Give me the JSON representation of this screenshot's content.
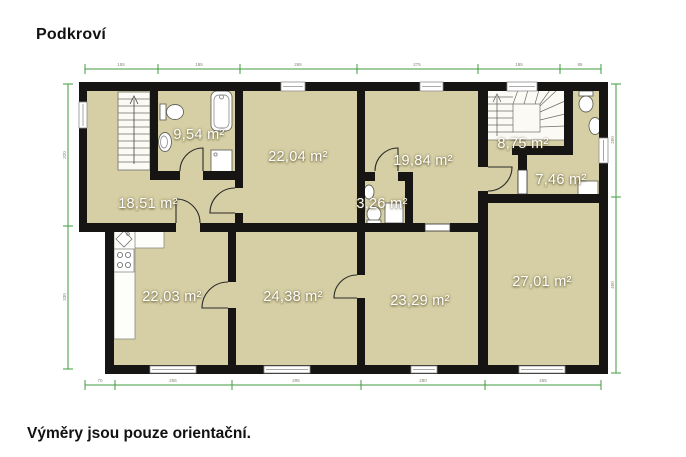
{
  "title": "Podkroví",
  "disclaimer": "Výměry jsou pouze orientační.",
  "rooms": [
    {
      "id": "bathroom-left",
      "area": "9,54 m²"
    },
    {
      "id": "room-top-center",
      "area": "22,04 m²"
    },
    {
      "id": "room-top-right",
      "area": "19,84 m²"
    },
    {
      "id": "staircase-room",
      "area": "8,75 m²"
    },
    {
      "id": "bathroom-right",
      "area": "7,46 m²"
    },
    {
      "id": "hallway",
      "area": "18,51 m²"
    },
    {
      "id": "wc",
      "area": "3,26 m²"
    },
    {
      "id": "kitchen",
      "area": "22,03 m²"
    },
    {
      "id": "room-bottom-left",
      "area": "24,38 m²"
    },
    {
      "id": "room-bottom-center",
      "area": "23,29 m²"
    },
    {
      "id": "room-bottom-right",
      "area": "27,01 m²"
    }
  ],
  "dimensions": {
    "top": [
      "155",
      "185",
      "265",
      "275",
      "185",
      "95"
    ],
    "bottom": [
      "70",
      "265",
      "295",
      "280",
      "265"
    ],
    "left": [
      "320",
      "330"
    ],
    "right": [
      "260",
      "400"
    ]
  },
  "colors": {
    "floor": "#d6cfa5",
    "wall": "#171513",
    "dimension": "#3f9b41"
  }
}
